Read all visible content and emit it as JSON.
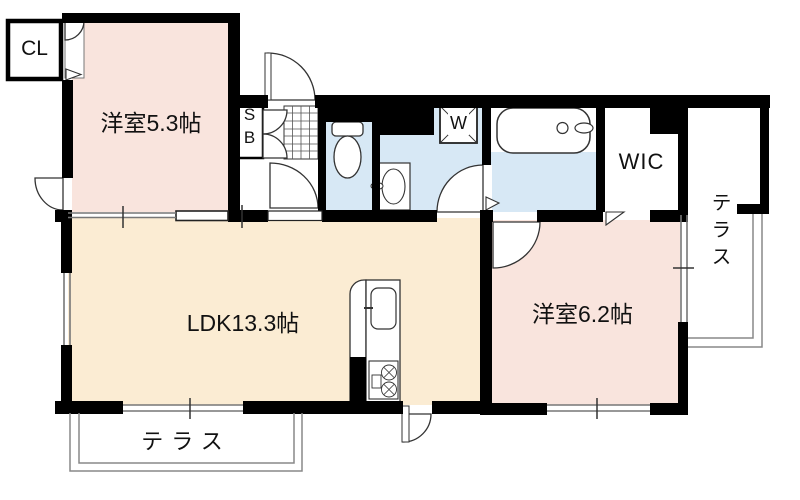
{
  "floorplan": {
    "labels": {
      "cl": "CL",
      "bedroom1": "洋室5.3帖",
      "sb_s": "S",
      "sb_b": "B",
      "washer": "W",
      "wic": "WIC",
      "ldk": "LDK13.3帖",
      "bedroom2": "洋室6.2帖",
      "terrace_bottom": "テラス",
      "terrace_right": "テラス"
    },
    "colors": {
      "wall": "#000000",
      "bedroom_pink": "#f9e4dd",
      "ldk_cream": "#fbecd3",
      "wet_area_blue": "#d7e8f5",
      "terrace_outline": "#888888",
      "fixture_line": "#333333"
    }
  }
}
